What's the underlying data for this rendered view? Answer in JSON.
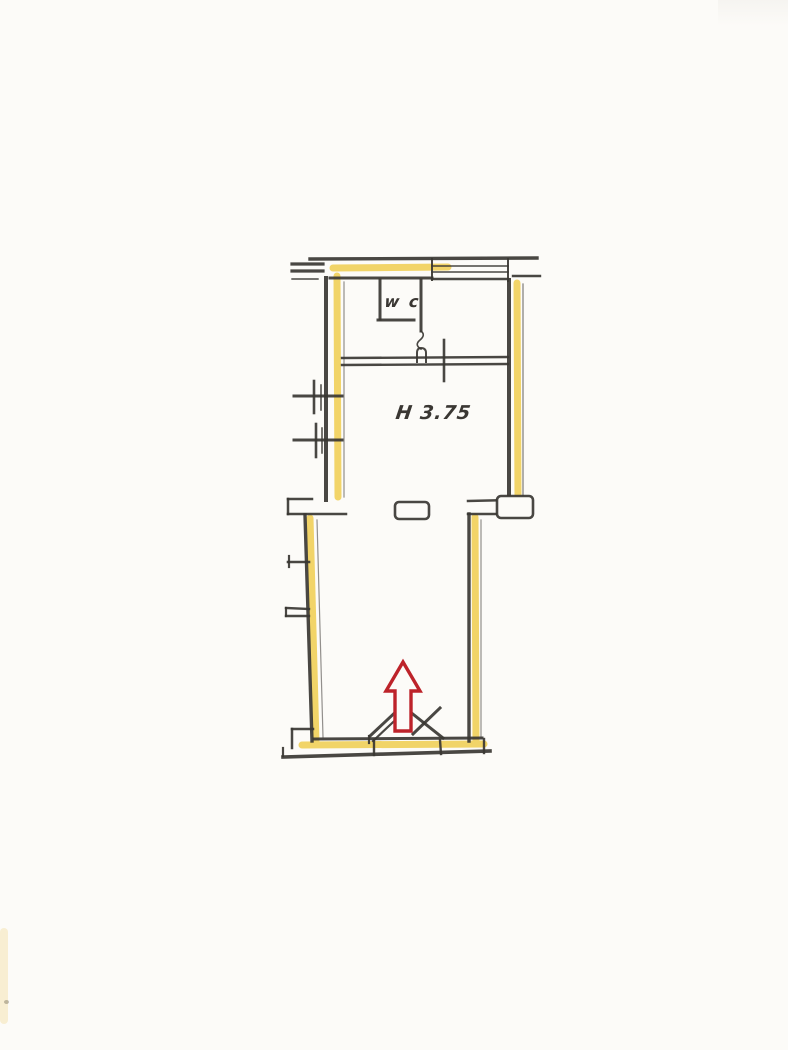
{
  "page": {
    "kind": "scanned floor plan sheet",
    "background": "#fcfbf8"
  },
  "plan": {
    "labels": {
      "wc": "w c",
      "ceiling_height": "H 3.75"
    },
    "colors": {
      "line": "#3a3733",
      "highlight": "#eec93f",
      "arrow": "#bd232a",
      "paper": "#fcfbf8"
    },
    "annotations": {
      "entrance_arrow": "red up arrow at entrance door"
    }
  }
}
